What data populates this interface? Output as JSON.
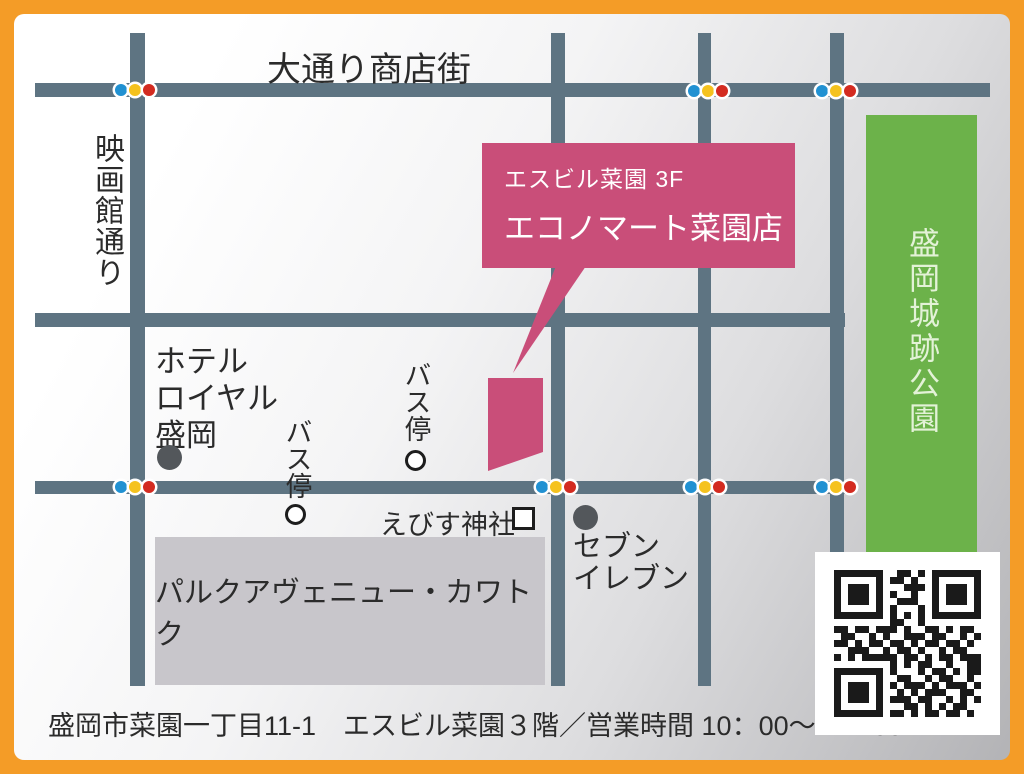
{
  "map": {
    "street_top": "大通り商店街",
    "street_left": "映画館通り",
    "callout": {
      "line1": "エスビル菜園 3F",
      "line2": "エコノマート菜園店"
    },
    "park": "盛岡城跡公園",
    "department_store": "パルクアヴェニュー・カワトク",
    "hotel": {
      "l1": "ホテル",
      "l2": "ロイヤル",
      "l3": "盛岡"
    },
    "bus_stop": "バス停",
    "shrine": "えびす神社",
    "convenience": {
      "l1": "セブン",
      "l2": "イレブン"
    }
  },
  "footer": {
    "address": "盛岡市菜園一丁目11-1　エスビル菜園３階／営業時間 10：00～17：00"
  },
  "colors": {
    "orange": "#F49C27",
    "road": "#5E7482",
    "pink": "#C94E79",
    "green": "#6CB24A",
    "park_text": "#E3F2D7",
    "gray_building": "#C8C6CB",
    "ink": "#2B2B2B",
    "dark_dot": "#53575B",
    "tl_blue": "#2191D2",
    "tl_yellow": "#F5C21E",
    "tl_red": "#D32B20"
  },
  "qr": {
    "matrix": [
      "111111100110101111111",
      "100000101101001000001",
      "101110100011101011101",
      "101110101001001011101",
      "101110100111001011101",
      "100000101000101000001",
      "111111101010101111111",
      "000000001100100000000",
      "110110111010011010110",
      "011001010011101100101",
      "110101101101011011010",
      "001110010110100101100",
      "101011111011010110111",
      "000000001010110010011",
      "111111101000101101011",
      "100000100110010110010",
      "101110101011101011101",
      "101110100101011100110",
      "101110101110110010101",
      "100000100011010101100",
      "111111101101011011010"
    ]
  }
}
